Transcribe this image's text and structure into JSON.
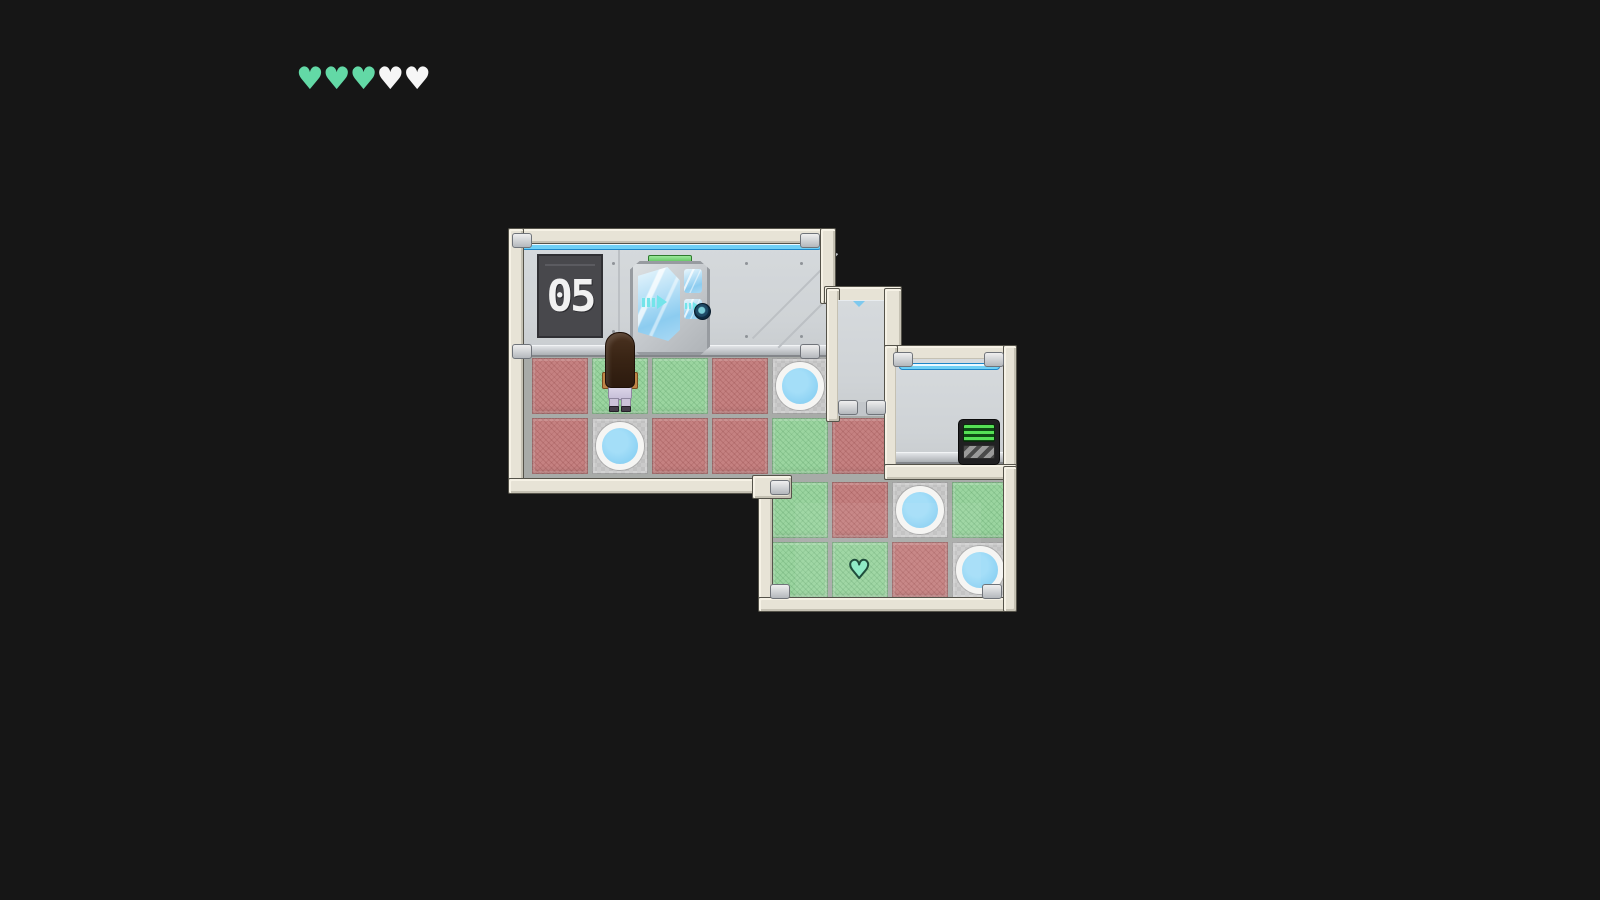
{
  "hud": {
    "hearts": {
      "total": 5,
      "filled": 3,
      "filled_color": "#63D9A6",
      "empty_color": "#F6F6F6"
    }
  },
  "level": {
    "sign_label": "05"
  },
  "board": {
    "rows": 4,
    "columns": 8,
    "tiles": [
      {
        "row": 1,
        "col": 1,
        "type": "red"
      },
      {
        "row": 1,
        "col": 2,
        "type": "green"
      },
      {
        "row": 1,
        "col": 3,
        "type": "green"
      },
      {
        "row": 1,
        "col": 4,
        "type": "red"
      },
      {
        "row": 1,
        "col": 5,
        "type": "pad"
      },
      {
        "row": 2,
        "col": 1,
        "type": "red"
      },
      {
        "row": 2,
        "col": 2,
        "type": "pad"
      },
      {
        "row": 2,
        "col": 3,
        "type": "red"
      },
      {
        "row": 2,
        "col": 4,
        "type": "red"
      },
      {
        "row": 2,
        "col": 5,
        "type": "green"
      },
      {
        "row": 2,
        "col": 6,
        "type": "red"
      },
      {
        "row": 3,
        "col": 5,
        "type": "green"
      },
      {
        "row": 3,
        "col": 6,
        "type": "red"
      },
      {
        "row": 3,
        "col": 7,
        "type": "pad"
      },
      {
        "row": 3,
        "col": 8,
        "type": "green"
      },
      {
        "row": 4,
        "col": 5,
        "type": "green"
      },
      {
        "row": 4,
        "col": 6,
        "type": "green"
      },
      {
        "row": 4,
        "col": 7,
        "type": "red"
      },
      {
        "row": 4,
        "col": 8,
        "type": "pad"
      }
    ],
    "player": {
      "row": 1,
      "col": 2,
      "facing": "up"
    },
    "pickup": {
      "type": "heart",
      "row": 4,
      "col": 6,
      "glyph": "♥",
      "color": "#8FEBC6"
    }
  },
  "objects": {
    "door": "exit-door-with-arrows",
    "terminal": "wall-terminal-green-screen",
    "sign": "level-number-plate"
  },
  "colors": {
    "background": "#161616",
    "frame_beige": "#E7E3D6",
    "wall_gray": "#D1D5D8",
    "floor_grout": "#A8ABA8",
    "tile_red": "#C58181",
    "tile_green": "#9BD5A0",
    "pad_circle": "#8FD3F4",
    "pad_ring": "#F5F5F3",
    "light_strip": "#5EC6F2",
    "door_green_bar": "#7ED87E",
    "terminal_screen": "#55E055"
  },
  "hud_heart_glyph": "♥"
}
